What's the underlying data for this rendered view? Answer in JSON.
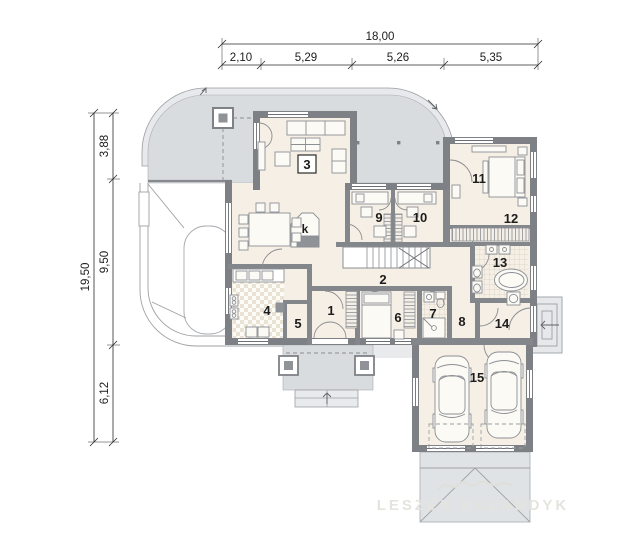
{
  "title": "house floor plan",
  "dimensions": {
    "top": {
      "total": "18,00",
      "segments": [
        "2,10",
        "5,29",
        "5,26",
        "5,35"
      ]
    },
    "left": {
      "total": "19,50",
      "segments": [
        "3,88",
        "9,50",
        "6,12"
      ]
    }
  },
  "rooms": {
    "r1": "1",
    "r2": "2",
    "r3": "3",
    "r4": "4",
    "r5": "5",
    "r6": "6",
    "r7": "7",
    "r8": "8",
    "r9": "9",
    "r10": "10",
    "r11": "11",
    "r12": "12",
    "r13": "13",
    "r14": "14",
    "r15": "15",
    "fireplace": "k"
  },
  "watermark": {
    "name": "LESZEK KALANDYK"
  },
  "colors": {
    "terrace": "#d9dcdf",
    "wall": "#7d8084",
    "interior": "#f6efe5",
    "accent": "#8f9297",
    "paper": "#ffffff"
  }
}
